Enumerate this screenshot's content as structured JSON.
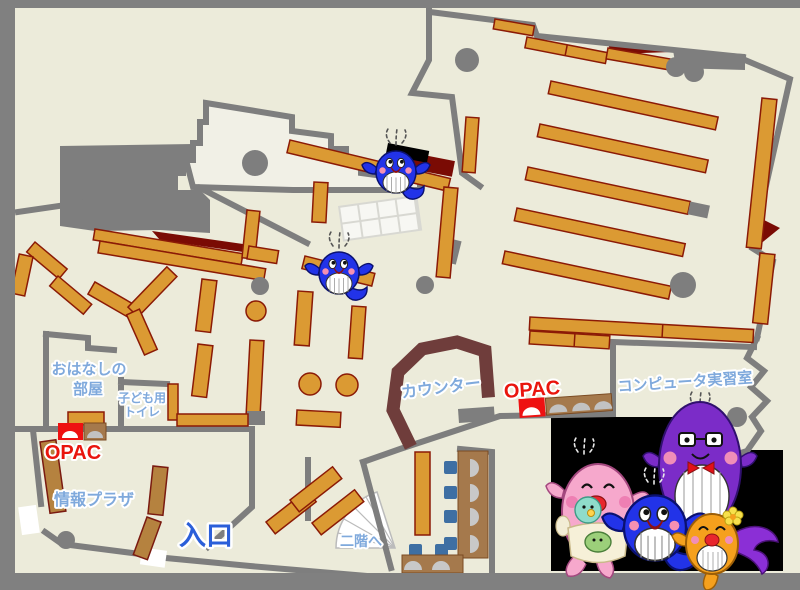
{
  "map": {
    "type": "library-floor-plan",
    "labels": {
      "storytelling_room": {
        "line1": "おはなしの",
        "line2": "部屋"
      },
      "kids_toilet": {
        "line1": "子ども用",
        "line2": "トイレ"
      },
      "opac_left": "OPAC",
      "info_plaza": "情報プラザ",
      "entrance": "入口",
      "to_second_floor": "二階へ",
      "counter": "カウンター",
      "opac_right": "OPAC",
      "computer_room": "コンピュータ実習室"
    },
    "colors": {
      "floor": "#ECEBDA",
      "room_light": "#F1F0E6",
      "frame_gray": "#808080",
      "wall_gray": "#7E7E7E",
      "shelf_orange": "#DB9A33",
      "shelf_border": "#8B1A06",
      "shelf_brown": "#B5823F",
      "dark_red": "#7A0B04",
      "counter_maroon": "#6F3D3B",
      "table_brown": "#A5794C",
      "chair_blue": "#3E6FA3",
      "opac_red": "#EE1111",
      "label_blue": "#7FA9DC",
      "entrance_blue": "#2B5FD9",
      "panel_black": "#000000"
    },
    "characters": {
      "map_mascots": [
        {
          "name": "blue-whale-mascot",
          "area": "upper-center-shelf"
        },
        {
          "name": "blue-whale-mascot",
          "area": "children-area-shelf"
        }
      ],
      "family_panel": [
        {
          "name": "pink-mother-whale-with-babies"
        },
        {
          "name": "blue-child-whale"
        },
        {
          "name": "purple-father-whale-glasses-bowtie"
        },
        {
          "name": "orange-child-whale-with-flower"
        }
      ]
    }
  }
}
